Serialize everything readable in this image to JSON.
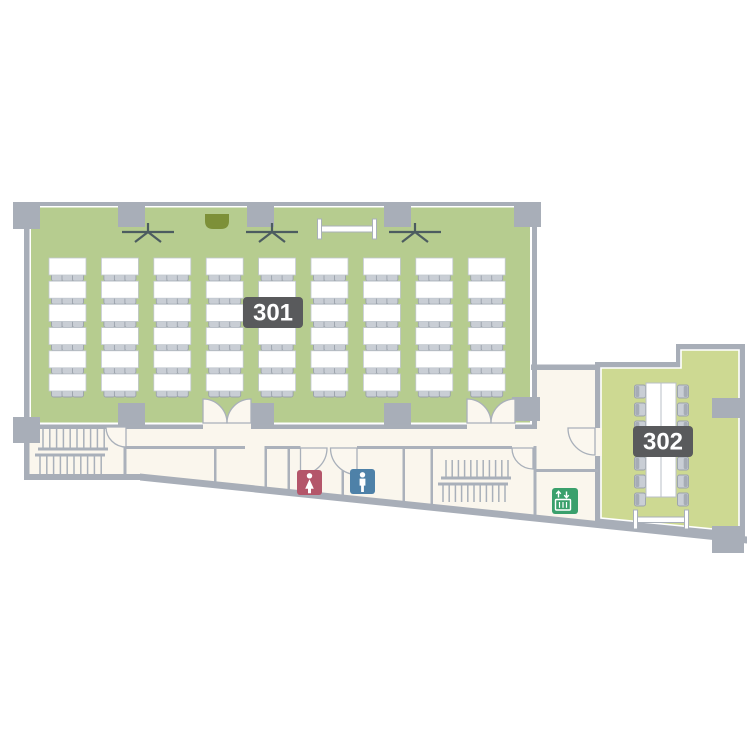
{
  "floor": {
    "rooms": [
      {
        "id": "301",
        "label": "301",
        "fill": "#b6cc8f",
        "furniture": {
          "desk_columns": 9,
          "desk_rows": 6,
          "chairs_per_desk": 3
        },
        "fixtures": [
          "coat-rack",
          "podium",
          "coat-rack",
          "projection-screen",
          "coat-rack"
        ]
      },
      {
        "id": "302",
        "label": "302",
        "fill": "#cdd992",
        "furniture": {
          "conference_table": true,
          "seats_per_side": 7
        },
        "fixtures": [
          "whiteboard"
        ]
      }
    ],
    "facilities": [
      {
        "id": "stairs-west"
      },
      {
        "id": "stairs-east"
      },
      {
        "id": "womens-restroom",
        "icon_color": "#b4566a"
      },
      {
        "id": "mens-restroom",
        "icon_color": "#4e81a8"
      },
      {
        "id": "elevator",
        "icon_color": "#3aa06c"
      }
    ],
    "colors": {
      "wall": "#a8aeb8",
      "thin_wall": "#abb1bb",
      "corridor_floor": "#faf6ed",
      "label_bg": "#595a5c",
      "label_text": "#ffffff",
      "desk": "#ffffff",
      "chair": "#c9ced5",
      "chair_back": "#a6acb5",
      "podium": "#7d9038",
      "fixture_line": "#4c5c60",
      "outside": "#ffffff"
    }
  }
}
